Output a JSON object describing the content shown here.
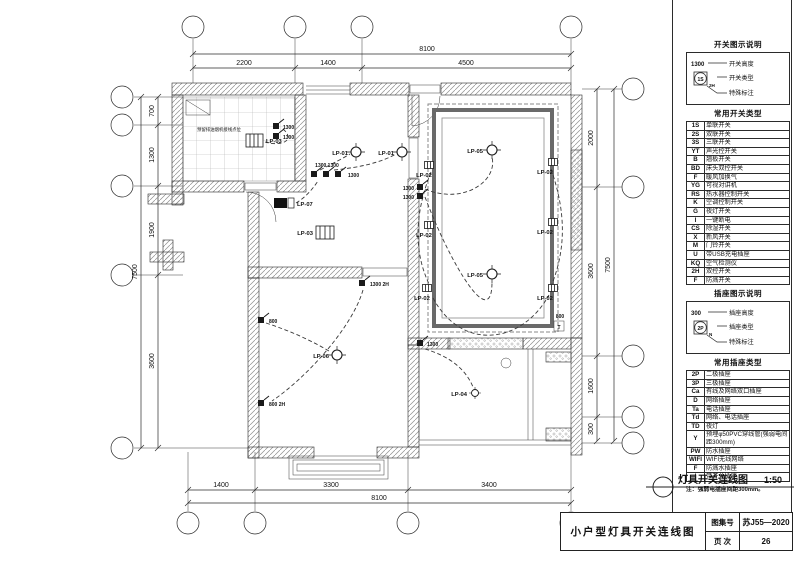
{
  "sheet": {
    "caption": "灯具开关连线图",
    "caption_scale": "1:50",
    "title_block": {
      "title": "小户型灯具开关连线图",
      "atlas_label": "图集号",
      "atlas_value": "苏J55—2020",
      "page_label": "页 次",
      "page_value": "26"
    }
  },
  "legend": {
    "switch_section": {
      "header": "开关图示说明",
      "height_value": "1300",
      "height_label": "开关高度",
      "symbol_code": "1S",
      "symbol_sub": "2H",
      "type_label": "开关类型",
      "note_label": "特殊标注",
      "table_header": "常用开关类型",
      "rows": [
        {
          "code": "1S",
          "label": "单联开关"
        },
        {
          "code": "2S",
          "label": "双联开关"
        },
        {
          "code": "3S",
          "label": "三联开关"
        },
        {
          "code": "YT",
          "label": "声光控开关"
        },
        {
          "code": "B",
          "label": "翘板开关"
        },
        {
          "code": "BD",
          "label": "床头双控开关"
        },
        {
          "code": "F",
          "label": "暖风加换气"
        },
        {
          "code": "YG",
          "label": "可视对讲机"
        },
        {
          "code": "RS",
          "label": "热水器控制开关"
        },
        {
          "code": "K",
          "label": "空调控制开关"
        },
        {
          "code": "G",
          "label": "夜灯开关"
        },
        {
          "code": "I",
          "label": "一键断电"
        },
        {
          "code": "CS",
          "label": "除湿开关"
        },
        {
          "code": "X",
          "label": "新风开关"
        },
        {
          "code": "M",
          "label": "门铃开关"
        },
        {
          "code": "U",
          "label": "带USB充电插座"
        },
        {
          "code": "KQ",
          "label": "空气检测仪"
        },
        {
          "code": "2H",
          "label": "双控开关"
        },
        {
          "code": "F",
          "label": "防溅开关"
        }
      ]
    },
    "socket_section": {
      "header": "插座图示说明",
      "height_value": "300",
      "height_label": "插座高度",
      "symbol_code": "2P",
      "symbol_sub": "N",
      "type_label": "插座类型",
      "note_label": "特殊标注",
      "table_header": "常用插座类型",
      "rows": [
        {
          "code": "2P",
          "label": "二极插座"
        },
        {
          "code": "3P",
          "label": "三极插座"
        },
        {
          "code": "Ca",
          "label": "有线及网络双口插座"
        },
        {
          "code": "D",
          "label": "网络插座"
        },
        {
          "code": "Ta",
          "label": "电话插座"
        },
        {
          "code": "Td",
          "label": "网络、电话插座"
        },
        {
          "code": "TD",
          "label": "夜灯"
        },
        {
          "code": "Y",
          "label": "预埋φ50PVC穿线管(强弱电间距300mm)"
        },
        {
          "code": "PW",
          "label": "防水插座"
        },
        {
          "code": "WIFI",
          "label": "WIFI无线网络"
        },
        {
          "code": "F",
          "label": "防溅水插座"
        },
        {
          "code": "I",
          "label": "带开关插座"
        }
      ],
      "note": "注：强弱电插座间距300mm。"
    }
  },
  "plan": {
    "dims": {
      "top_total": "8100",
      "top": [
        "2200",
        "1400",
        "4500"
      ],
      "bottom": [
        "1400",
        "3300",
        "3400"
      ],
      "bottom_total": "8100",
      "left": [
        "700",
        "1300",
        "1900",
        "3600"
      ],
      "left_total": "7500",
      "right": [
        "2000",
        "3600",
        "1600",
        "300"
      ],
      "right_total": "7500"
    },
    "labels": {
      "lp01": "LP-01",
      "lp02": "LP-02",
      "lp03": "LP-03",
      "lp04": "LP-04",
      "lp05": "LP-05",
      "lp06": "LP-06",
      "lp07": "LP-07"
    },
    "annotations": {
      "pair1300": "1300 1300",
      "h1300": "1300",
      "h800": "800",
      "h1300_2h": "1300 2H",
      "h800_2h": "800 2H",
      "t_mark": "T",
      "kitchen_note": "预留排油烟机接线点位"
    }
  }
}
